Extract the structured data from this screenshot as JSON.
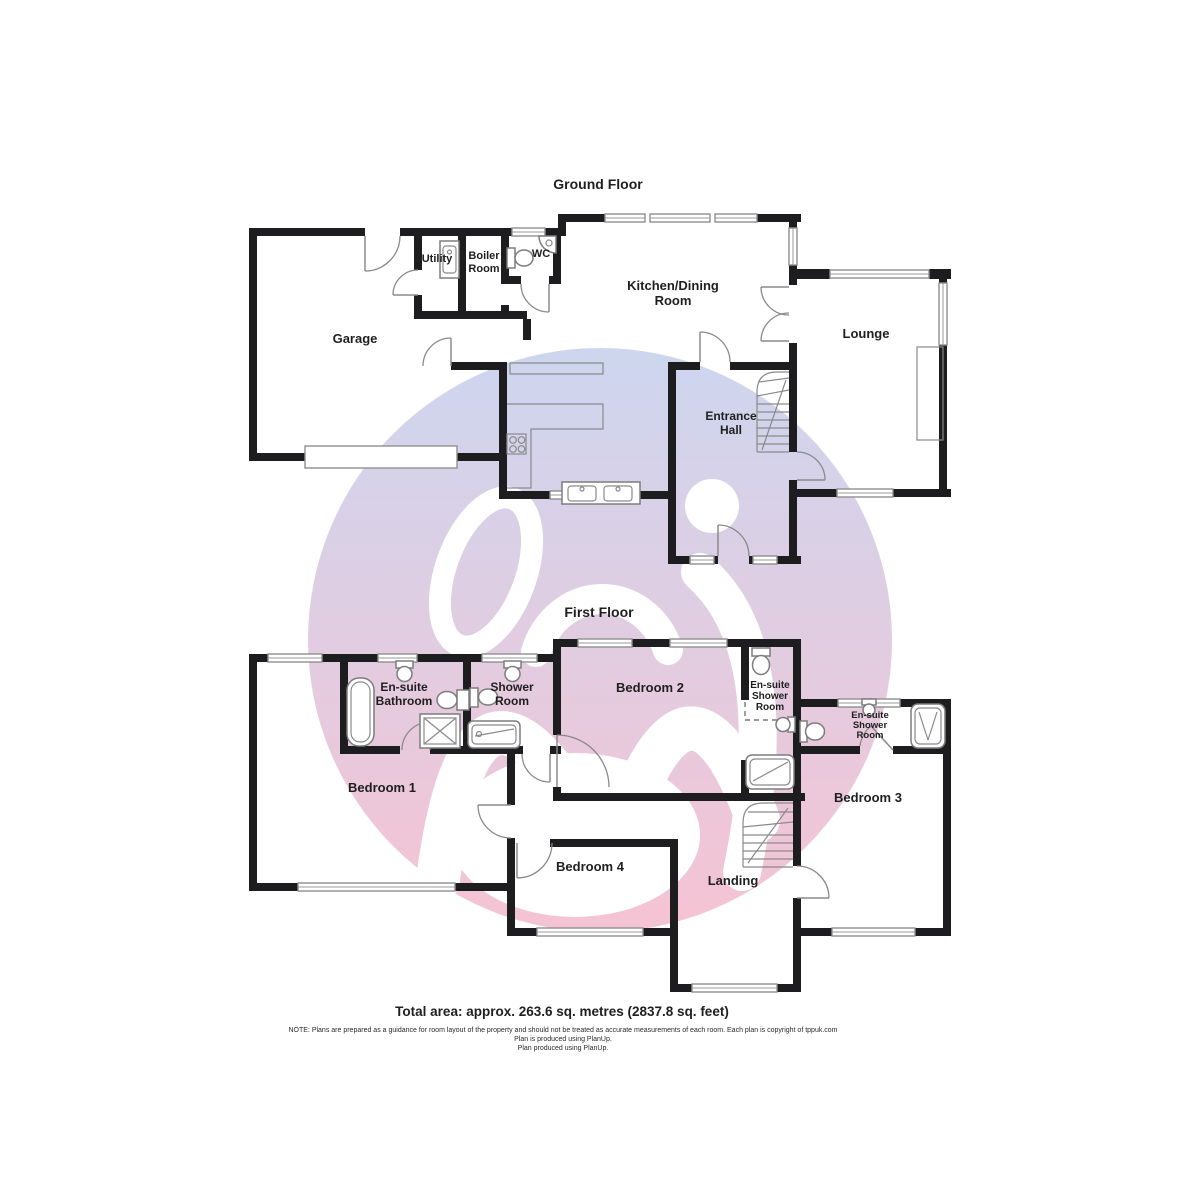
{
  "colors": {
    "watermark_top": "#cdd6ef",
    "watermark_bottom": "#f5c3d3",
    "wall": "#1d1d20",
    "label_text": "#1f1f1f"
  },
  "titles": {
    "ground_floor": "Ground Floor",
    "first_floor": "First Floor"
  },
  "ground_floor": {
    "garage": "Garage",
    "utility": "Utility",
    "boiler_room": {
      "line1": "Boiler",
      "line2": "Room"
    },
    "wc": "WC",
    "kitchen_dining": {
      "line1": "Kitchen/Dining",
      "line2": "Room"
    },
    "lounge": "Lounge",
    "entrance_hall": {
      "line1": "Entrance",
      "line2": "Hall"
    }
  },
  "first_floor": {
    "bedroom1": "Bedroom 1",
    "bedroom2": "Bedroom 2",
    "bedroom3": "Bedroom 3",
    "bedroom4": "Bedroom 4",
    "landing": "Landing",
    "ensuite_bathroom": {
      "line1": "En-suite",
      "line2": "Bathroom"
    },
    "shower_room": {
      "line1": "Shower",
      "line2": "Room"
    },
    "ensuite_shower_bed2": {
      "line1": "En-suite",
      "line2": "Shower",
      "line3": "Room"
    },
    "ensuite_shower_bed3": {
      "line1": "En-suite",
      "line2": "Shower",
      "line3": "Room"
    }
  },
  "footer": {
    "total_area": "Total area: approx. 263.6 sq. metres (2837.8 sq. feet)",
    "note": "NOTE: Plans are prepared as a guidance for room layout of the property and should not be treated as accurate measurements of each room. Each plan is copyright of tppuk.com",
    "produced_line1": "Plan is produced using PlanUp.",
    "produced_line2": "Plan produced using PlanUp."
  }
}
